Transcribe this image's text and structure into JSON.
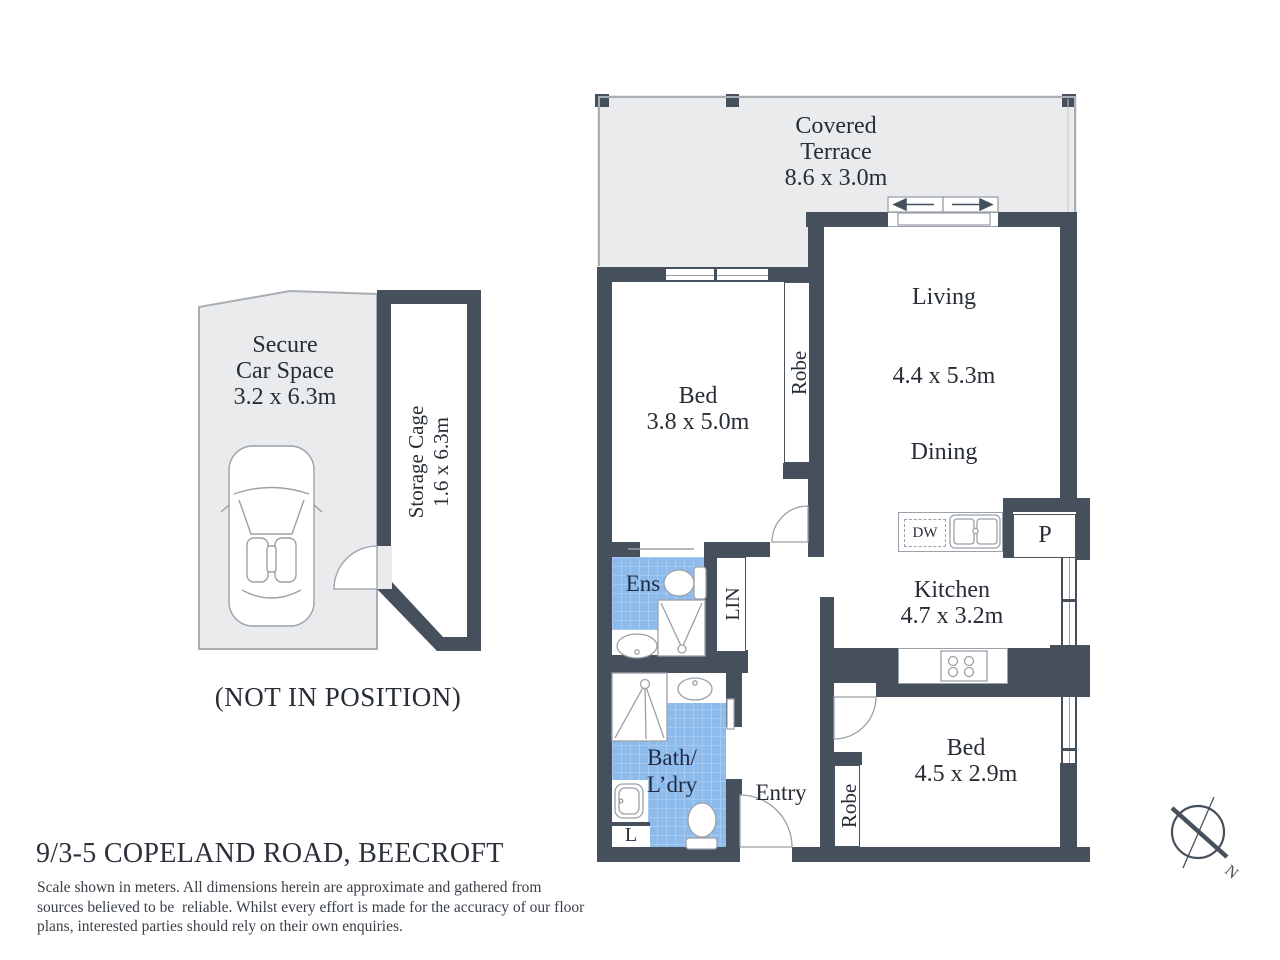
{
  "title": {
    "address": "9/3-5 COPELAND ROAD, BEECROFT"
  },
  "disclaimer": {
    "line1": "Scale shown in meters. All dimensions herein are approximate and gathered from",
    "line2": "sources believed to be  reliable. Whilst every effort is made for the accuracy of our floor",
    "line3": "plans, interested parties should rely on their own enquiries."
  },
  "rooms": {
    "terrace": {
      "line1": "Covered",
      "line2": "Terrace",
      "dims": "8.6 x 3.0m"
    },
    "living": {
      "name": "Living",
      "dims": "4.4 x 5.3m"
    },
    "dining": {
      "name": "Dining"
    },
    "bed1": {
      "name": "Bed",
      "dims": "3.8 x 5.0m"
    },
    "bed2": {
      "name": "Bed",
      "dims": "4.5 x 2.9m"
    },
    "kitchen": {
      "name": "Kitchen",
      "dims": "4.7 x 3.2m"
    },
    "ensuite": {
      "name": "Ens"
    },
    "bath": {
      "line1": "Bath/",
      "line2": "L’dry"
    },
    "entry": {
      "name": "Entry"
    },
    "linen": {
      "name": "LIN"
    },
    "laundry_cupboard": {
      "name": "L"
    },
    "pantry": {
      "name": "P"
    },
    "dishwasher": {
      "name": "DW"
    },
    "robe_bed1": {
      "name": "Robe"
    },
    "robe_bed2": {
      "name": "Robe"
    }
  },
  "garage": {
    "car_space": {
      "line1": "Secure",
      "line2": "Car Space",
      "dims": "3.2 x 6.3m"
    },
    "storage": {
      "name": "Storage Cage",
      "dims": "1.6 x 6.3m"
    },
    "note": "(NOT IN POSITION)"
  },
  "compass": {
    "label": "N"
  },
  "colors": {
    "wall": "#46505d",
    "terrace_fill": "#e9ebec",
    "tile_blue": "#8dbbec",
    "tile_grid": "#a6c9f1",
    "fixture_stroke": "#9aa1a8",
    "text": "#272d36"
  }
}
